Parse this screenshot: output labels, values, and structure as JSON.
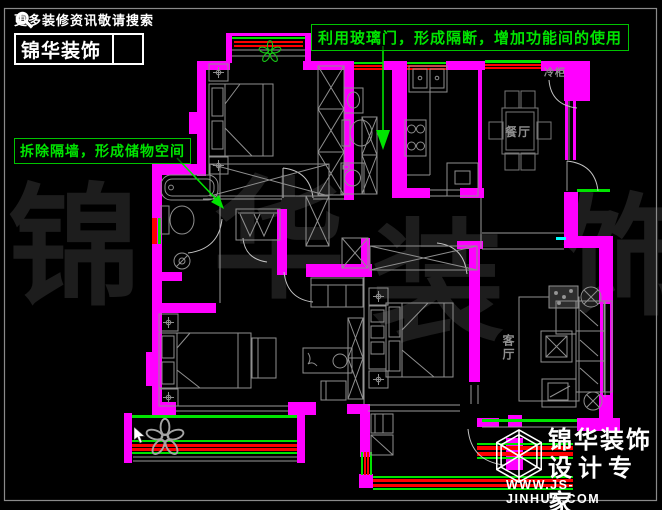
{
  "header_logo": {
    "tagline": "更多装修资讯敬请搜索",
    "brand": "锦华装饰",
    "search_icon": "magnifier"
  },
  "annotations": {
    "glass_door": "利用玻璃门，形成隔断，增加功能间的使用",
    "storage": "拆除隔墙，形成储物空间"
  },
  "room_labels": {
    "dining": "餐厅",
    "living": "客厅",
    "freezer": "冷柜"
  },
  "watermark": {
    "char1": "锦",
    "char2": "华",
    "char3": "装",
    "char4": "饰"
  },
  "footer_logo": {
    "brand": "锦华装饰",
    "subtitle": "设计专家",
    "website": "WWW.JS-JINHUA.COM",
    "logo_icon": "isometric-cube"
  },
  "colors": {
    "background": "#000000",
    "wall": "#ff00ff",
    "window_green": "#00e400",
    "window_red": "#ff0000",
    "annotation_green": "#00e400",
    "furniture_gray": "#8f8f8f",
    "watermark_gray": "#1d1d1d",
    "page_border": "#8a8a8a",
    "cyan_mark": "#00ffff"
  }
}
